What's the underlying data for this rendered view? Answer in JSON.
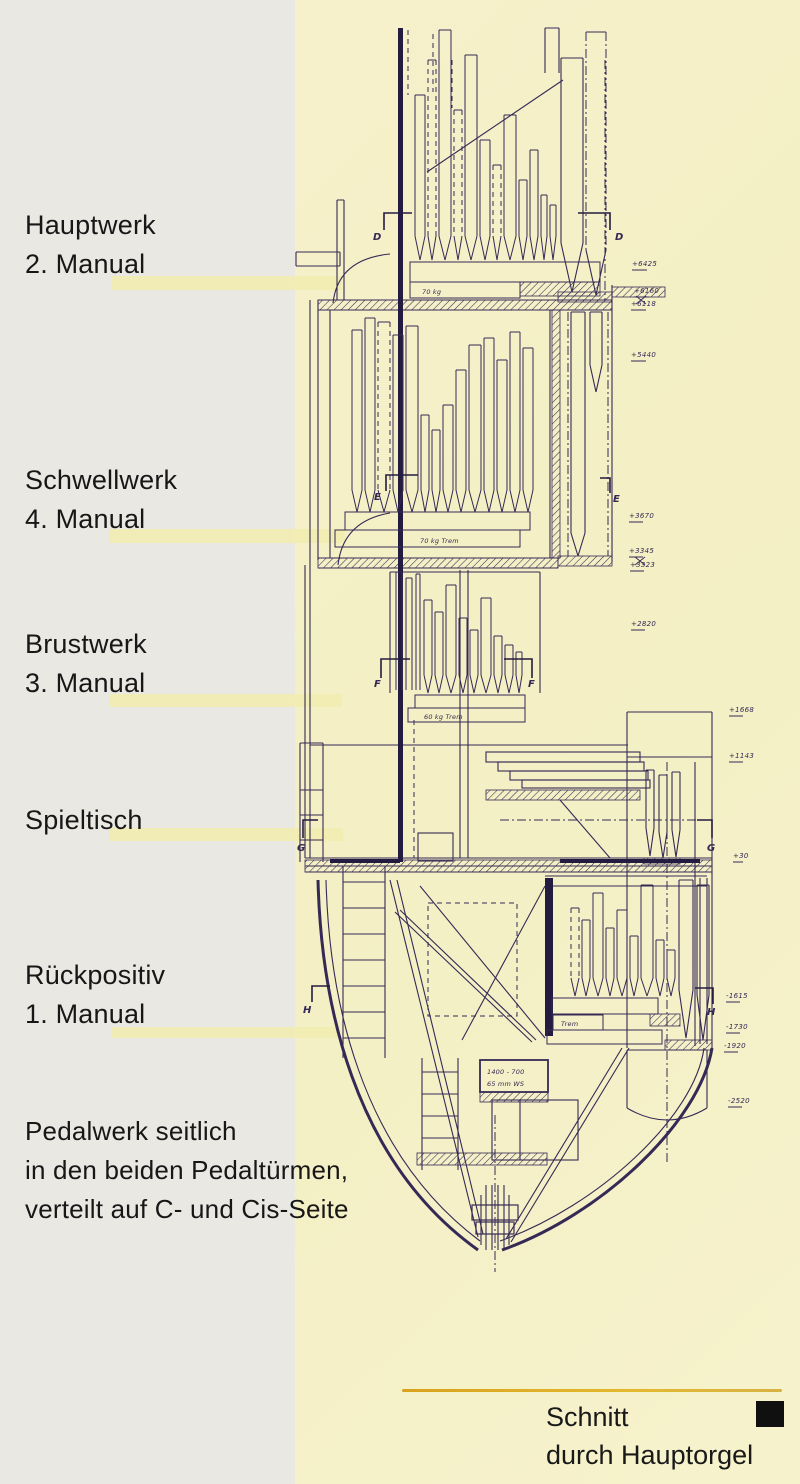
{
  "sidebar": {
    "groups": [
      {
        "lines": [
          "Hauptwerk",
          "2. Manual"
        ]
      },
      {
        "lines": [
          "Schwellwerk",
          "4. Manual"
        ]
      },
      {
        "lines": [
          "Brustwerk",
          "3. Manual"
        ]
      },
      {
        "lines": [
          "Spieltisch"
        ]
      },
      {
        "lines": [
          "Rückpositiv",
          "1. Manual"
        ]
      },
      {
        "lines": [
          "Pedalwerk seitlich",
          "in den beiden Pedaltürmen,",
          "verteilt auf C- und Cis-Seite"
        ]
      }
    ]
  },
  "caption": {
    "line1": "Schnitt",
    "line2": "durch Hauptorgel"
  },
  "drawing": {
    "section_markers": {
      "d": "D",
      "e": "E",
      "f": "F",
      "g": "G",
      "h": "H"
    },
    "chest_labels": {
      "hauptwerk": "70 kg",
      "schwellwerk": "70 kg Trem",
      "brustwerk": "60 kg Trem",
      "rueckpositiv": "Trem",
      "bellows_size": "1400 - 700",
      "wind_pressure": "65 mm WS"
    },
    "elevations": [
      "+6425",
      "+6160",
      "+6118",
      "+5440",
      "+3670",
      "+3345",
      "+3323",
      "+2820",
      "+1668",
      "+1143",
      "+30",
      "-1615",
      "-1730",
      "-1920",
      "-2520"
    ]
  },
  "colors": {
    "sidebar_background": "#e9e8e3",
    "drawing_background": "#f5f0c8",
    "highlight_bar": "#f1ecb2",
    "ink": "#352a55",
    "gold_rule": "#d9a21c",
    "end_square": "#101010"
  }
}
